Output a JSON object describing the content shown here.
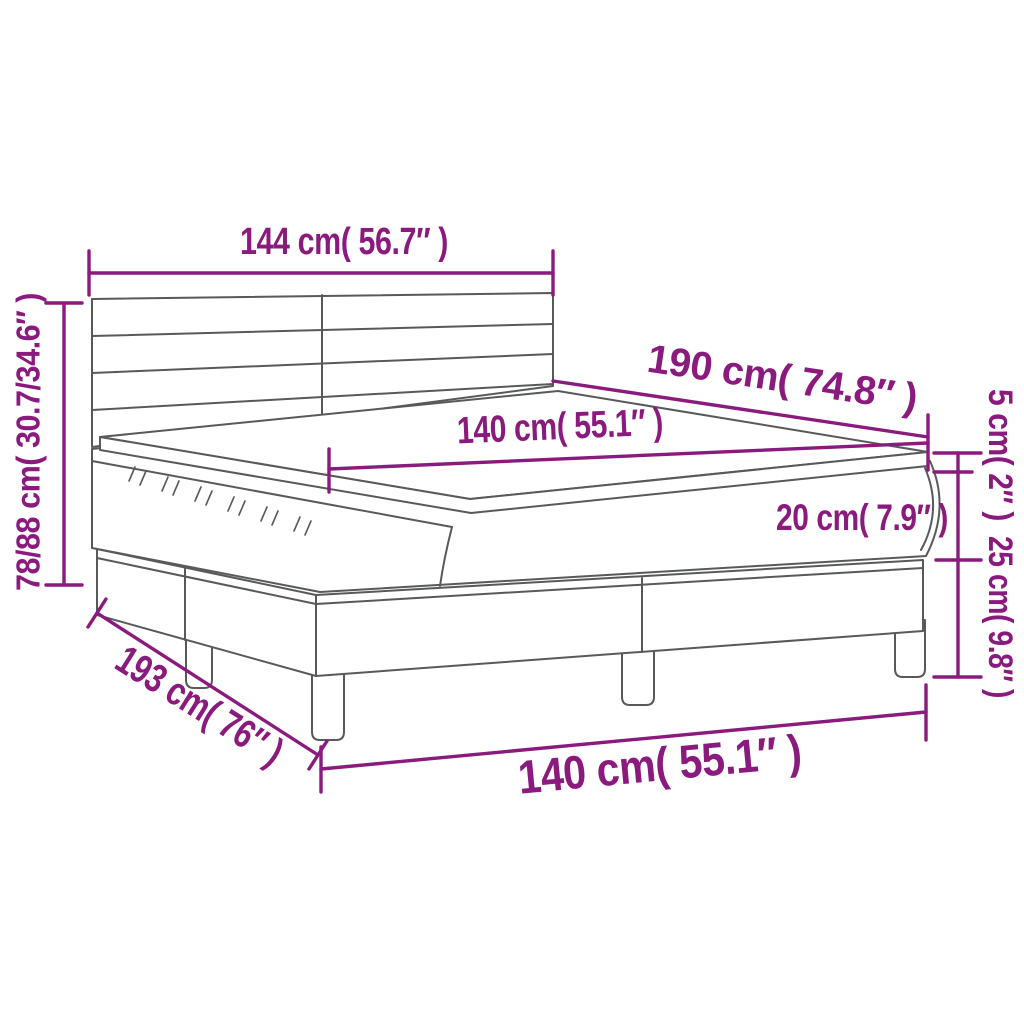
{
  "diagram": {
    "colors": {
      "dimension": "#8A1A7D",
      "outline": "#58595B",
      "background": "#FFFFFF"
    },
    "dimensions": {
      "headboard_width": "144 cm( 56.7″ )",
      "overall_height": "78/88 cm( 30.7/34.6″ )",
      "length_top": "190 cm( 74.8″ )",
      "mattress_width": "140 cm( 55.1″ )",
      "topper_height": "5 cm( 2″ )",
      "mattress_height": "20 cm( 7.9″ )",
      "base_height": "25 cm( 9.8″ )",
      "length_bottom": "193 cm( 76″ )",
      "width_bottom": "140 cm( 55.1″ )"
    }
  }
}
